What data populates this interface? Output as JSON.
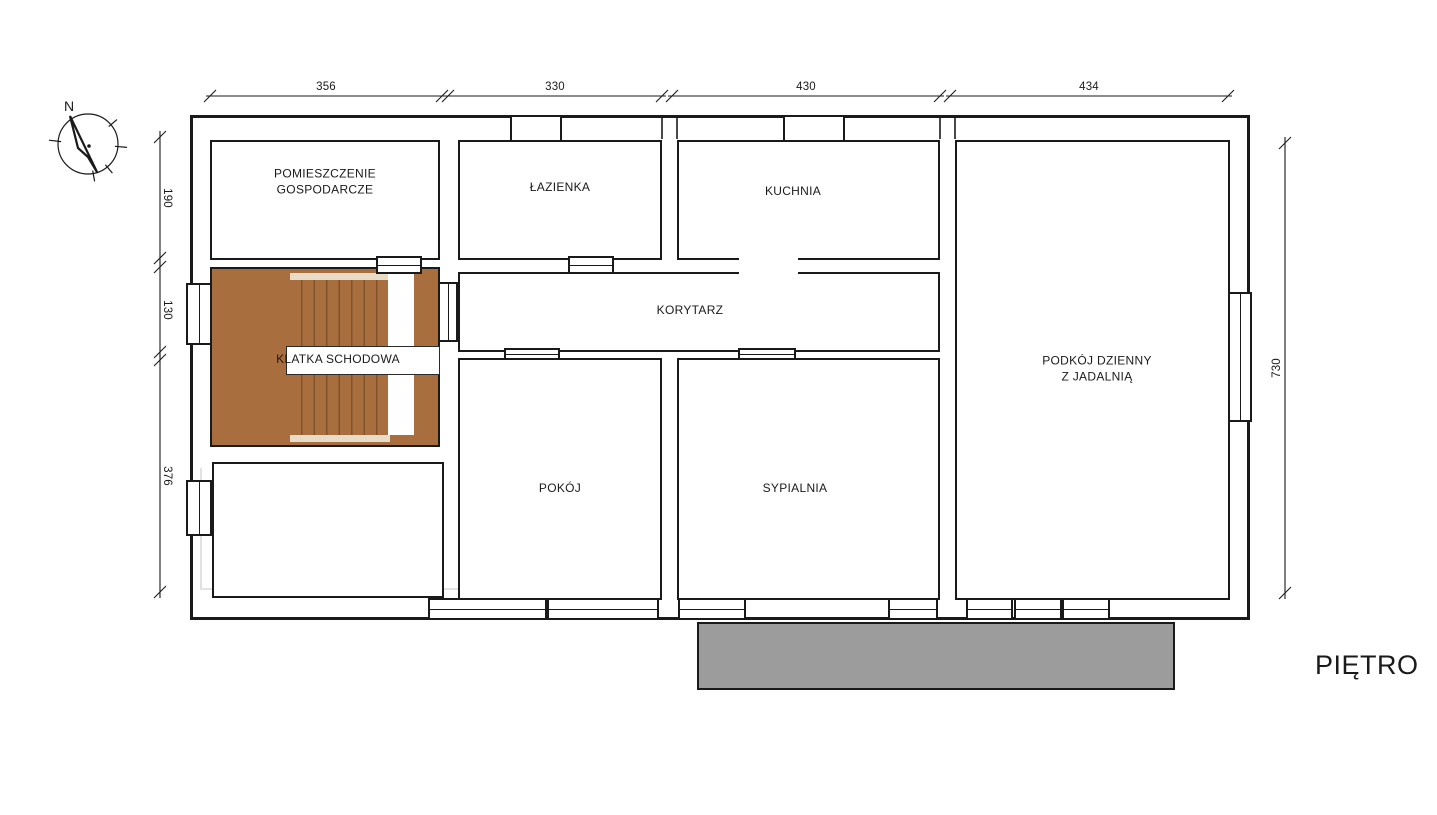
{
  "title": "PIĘTRO",
  "compass": {
    "north_label": "N"
  },
  "dimensions": {
    "top": [
      "356",
      "330",
      "430",
      "434"
    ],
    "left": [
      "190",
      "130",
      "376"
    ],
    "right": [
      "730"
    ]
  },
  "rooms": {
    "utility": {
      "label": "POMIESZCZENIE GOSPODARCZE"
    },
    "bathroom": {
      "label": "ŁAZIENKA"
    },
    "kitchen": {
      "label": "KUCHNIA"
    },
    "corridor": {
      "label": "KORYTARZ"
    },
    "staircase": {
      "label": "KLATKA SCHODOWA"
    },
    "living_room": {
      "label": "PODKÓJ DZIENNY Z JADALNIĄ"
    },
    "room": {
      "label": "POKÓJ"
    },
    "bedroom": {
      "label": "SYPIALNIA"
    }
  },
  "colors": {
    "line": "#1a1a1a",
    "stairs": "#A96E3E",
    "stairs_light": "#E8DCC8",
    "balcony": "#9C9C9C",
    "ghost": "#DADADA"
  }
}
